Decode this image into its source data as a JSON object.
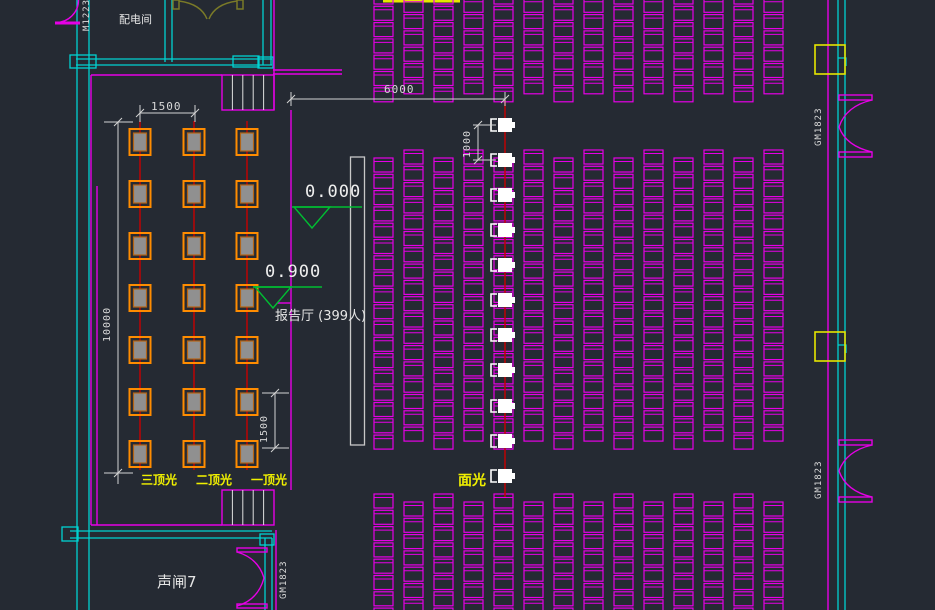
{
  "app": {
    "type": "CAD theater lighting floor plan",
    "background": "#252a33"
  },
  "labels": {
    "power_room": "配电间",
    "door_tag_m1223": "M1223",
    "hall_capacity": "报告厅 (399人)",
    "sound_lock_room": "声闸7",
    "door_tag_right_top": "GM1823",
    "door_tag_right_bottom": "GM1823",
    "door_tag_bottom": "GM1823",
    "top_light_3": "三顶光",
    "top_light_2": "二顶光",
    "top_light_1": "一顶光",
    "front_light": "面光"
  },
  "elevations": {
    "audience_floor": "0.000",
    "stage": "0.900"
  },
  "dimensions": {
    "stage_light_column_spacing": "1500",
    "stage_to_front_light": "6000",
    "front_light_spacing": "1000",
    "stage_depth": "10000",
    "stage_light_row_spacing": "1500"
  },
  "plan_stats": {
    "seat_columns": 14,
    "seat_rows_top_block": 7,
    "seat_rows_main_block": 18,
    "seat_rows_bottom_block": 8,
    "stage_light_columns": 3,
    "stage_light_rows": 7,
    "front_light_fixtures": 11,
    "stair_treads": 5
  },
  "colors": {
    "wall": "#00d2d2",
    "partition": "#e600e6",
    "seat": "#e600e6",
    "dimension": "#d4d4d4",
    "elevation": "#00be32",
    "highlight_label": "#f0f000",
    "stage_light": "#ff8c00",
    "stage_light_fill": "#909090",
    "wiring": "#c80000",
    "door_olive": "#7a7a28",
    "stage_edge": "#c8c8c8",
    "fixture_white": "#ffffff",
    "column_yellow": "#e6e600"
  }
}
